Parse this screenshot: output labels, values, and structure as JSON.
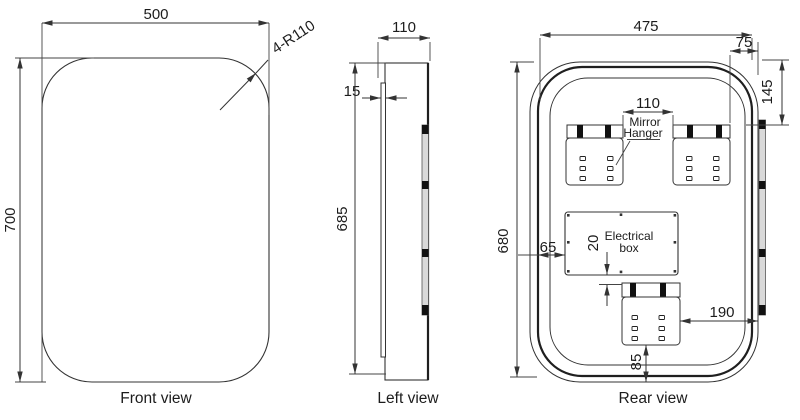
{
  "drawing_title": "Mirror technical drawing - three orthographic views",
  "views": {
    "front": {
      "label": "Front view",
      "dims": {
        "width": "500",
        "height": "700",
        "corner_radius": "4-R110"
      }
    },
    "left": {
      "label": "Left view",
      "dims": {
        "depth": "110",
        "glass_thickness": "15",
        "height": "685"
      }
    },
    "rear": {
      "label": "Rear view",
      "dims": {
        "width": "475",
        "hanger_side_offset": "75",
        "hanger_top_offset": "145",
        "hanger_gap": "110",
        "height": "680",
        "box_side_offset": "65",
        "box_bottom_gap": "20",
        "bottom_hanger_side_offset": "190",
        "bottom_hanger_bottom_offset": "85"
      },
      "annotations": {
        "mirror_hanger_line1": "Mirror",
        "mirror_hanger_line2": "Hanger",
        "electrical_box_line1": "Electrical",
        "electrical_box_line2": "box"
      }
    }
  },
  "colors": {
    "background": "#ffffff",
    "line": "#333333",
    "thick_outline": "#1f1f1f",
    "hanger_bar_fill": "#d9d9d9",
    "hanger_bar_band": "#111111"
  }
}
